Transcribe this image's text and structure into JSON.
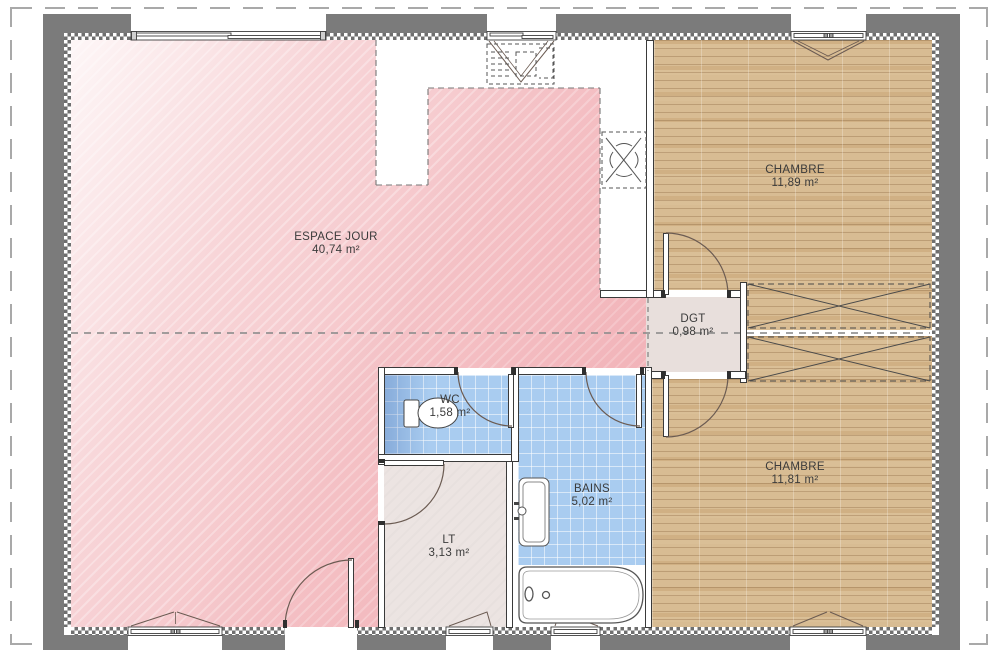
{
  "rooms": [
    {
      "name": "ESPACE JOUR",
      "area": "40,74 m²"
    },
    {
      "name": "CHAMBRE",
      "area": "11,89 m²"
    },
    {
      "name": "DGT",
      "area": "0,98 m²"
    },
    {
      "name": "WC",
      "area": "1,58 m²"
    },
    {
      "name": "BAINS",
      "area": "5,02 m²"
    },
    {
      "name": "LT",
      "area": "3,13 m²"
    },
    {
      "name": "CHAMBRE",
      "area": "11,81 m²"
    }
  ],
  "colors": {
    "floor_living_pink": "#f5c6ca",
    "floor_bedroom_wood": "#d8bc93",
    "floor_bath_tile": "#a9ccf0",
    "floor_lt": "#ece4e2",
    "floor_dgt": "#e8dfdc",
    "exterior_wall": "#7b7b7b"
  }
}
